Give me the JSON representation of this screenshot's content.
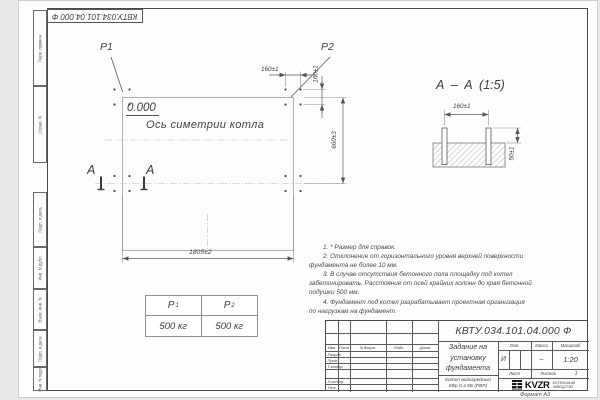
{
  "sheet": {
    "format_note": "Формат А3"
  },
  "top_stamp": {
    "designation": "КВТУ.034.101.04.000  Ф"
  },
  "margin": {
    "labels": [
      "Перв. примен.",
      "Справ. N",
      "Подп. и дата",
      "Инв. N дубл.",
      "Взам. инв. N",
      "Подп. и дата",
      "Инв. N подл."
    ]
  },
  "plan": {
    "p1": "Р1",
    "p2": "Р2",
    "elevation": "0.000",
    "axis_label": "Ось симетрии котла",
    "section_mark_left": "А",
    "section_mark_right": "А",
    "dim_length": "1805±2",
    "dim_height": "660±3",
    "dim_bolt_horizontal": "160±1",
    "dim_bolt_vertical": "160±1"
  },
  "section_view": {
    "title": "А – А (1:5)",
    "dim_span": "160±1",
    "dim_protrusion": "50±1"
  },
  "load_table": {
    "col1_header": "Р",
    "col1_sub": "1",
    "col2_header": "Р",
    "col2_sub": "2",
    "col1_value": "500 кг",
    "col2_value": "500 кг"
  },
  "notes": [
    "1.  * Размер для справок.",
    "2.  Отклонение от горизонтального уровня верхней поверхности\nфундамента не более 10 мм.",
    "3.  В случае отсутствия бетонного пола площадку под котел\nзабетонировать. Расстояние от осей крайних колонн до края бетонной\nподушки 500 мм.",
    "4.  Фундамент под котел разрабатывает проектная организация\nпо нагрузкам на фундамент."
  ],
  "title_block": {
    "designation": "КВТУ.034.101.04.000  Ф",
    "doc_title": "Задание на\nустановку\nфундамента",
    "product": "Котел водогрейный\nКВр-0,4  КБ  (РВР)",
    "cols": {
      "izm": "Изм.",
      "list": "Лист",
      "ndoc": "N докум.",
      "podp": "Подп.",
      "data": "Дата"
    },
    "rows": {
      "razrab": "Разраб.",
      "prov": "Пров.",
      "tkontr": "Т.контр.",
      "nkontr": "Н.контр.",
      "utv": "Утв."
    },
    "lit_label": "Лит.",
    "mass_label": "Масса",
    "scale_label": "Масштаб",
    "lit_value": "И",
    "mass_value": "–",
    "scale_value": "1:20",
    "list_label": "Лист",
    "listov_label": "Листов",
    "listov_value": "1",
    "logo": {
      "ooo": "ООО",
      "name": "KVZR",
      "sub1": "КОТЕЛЬНЫЙ",
      "sub2": "ЗАВОД РЭП"
    }
  }
}
